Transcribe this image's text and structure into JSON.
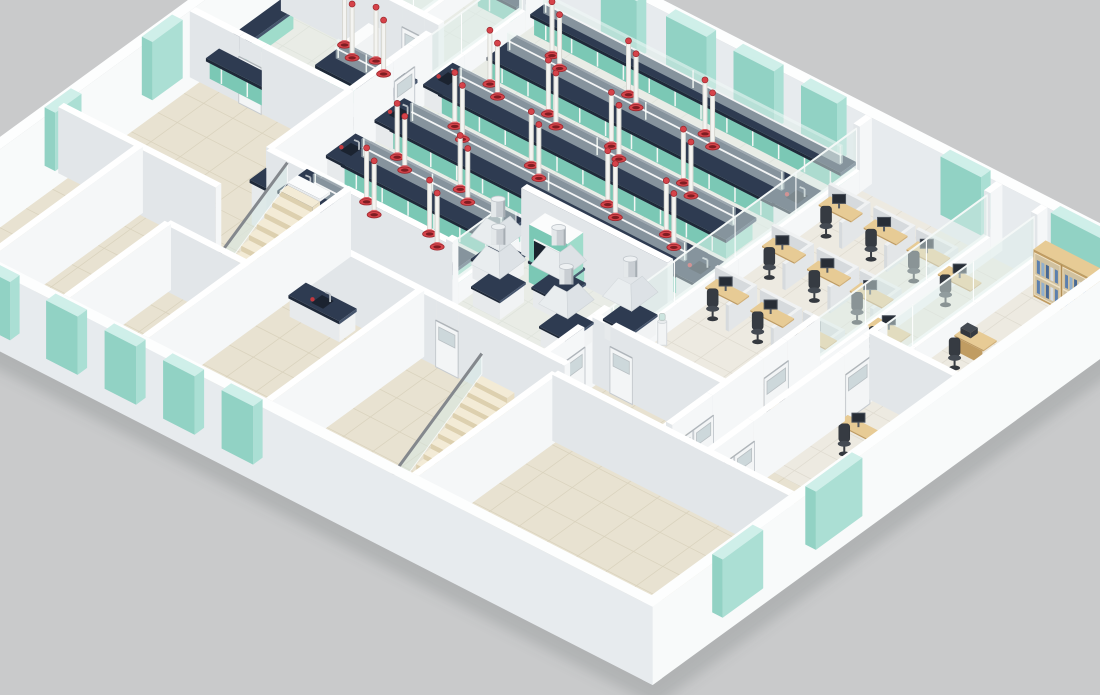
{
  "palette": {
    "background": "#c9cacb",
    "shadow": "rgba(95,98,100,0.22)",
    "wall_top": "#ffffff",
    "wall_se": "#f5f7f8",
    "wall_sw": "#e2e6e9",
    "ext_top": "#fdfefe",
    "ext_se": "#f8fafa",
    "ext_sw": "#e7ebee",
    "floor_lab": "#e9ece6",
    "floor_lab_line": "#dee3db",
    "floor_beige": "#e8e2d1",
    "floor_beige_line": "#d9d2bd",
    "floor_office": "#edeae1",
    "floor_office_line": "#dfdbd0",
    "counter_navy_top": "#2e3b51",
    "counter_navy_se": "#46556d",
    "counter_navy_sw": "#1f2939",
    "cabinet_teal_top": "#c9eee4",
    "cabinet_teal_se": "#9fdccb",
    "cabinet_teal_sw": "#7bc8b5",
    "window_teal_top": "#cdeee8",
    "window_teal_se": "#a8ded2",
    "window_teal_sw": "#8ed0c2",
    "glass_clear": "rgba(222,238,234,0.5)",
    "glass_edge": "rgba(255,255,255,0.85)",
    "wood_top": "#e7cb95",
    "wood_se": "#d2b077",
    "wood_sw": "#c09c62",
    "partition_top": "#f0f2f3",
    "partition_se": "#e3e6e8",
    "partition_sw": "#d6dadd",
    "stair_top": "#f3ebd6",
    "stair_se": "#eadfc4",
    "stair_sw": "#ddd0af",
    "white_top": "#fbfcfc",
    "white_se": "#f1f3f4",
    "white_sw": "#e7eaec",
    "extractor_red": "#d6434a",
    "extractor_red_deep": "#7e1d22",
    "extractor_red_edge": "#9c272d",
    "extractor_cone": "#e06066",
    "extractor_pole": "#f4f4f1",
    "extractor_pole_edge": "#d8d8d2",
    "chair_seat": "#444a52",
    "chair_back": "#363b42",
    "chair_base": "#34383e",
    "monitor": "#272d36",
    "monitor_edge": "#49505a",
    "chrome": "#c9ced3",
    "chrome_light": "#e4e8ea",
    "chrome_dark": "#a6adb3",
    "chrome_cap": "#eef1f3",
    "rail": "#84888d",
    "faucet": "#b9bfc5",
    "sink": "#1b2330",
    "bottle_red": "#c2383e",
    "door_leaf": "#f3f5f6",
    "door_edge": "#c6cbd0",
    "door_lite": "rgba(198,210,214,0.85)",
    "book_colors": [
      "#5b7fae",
      "#90b0cf",
      "#476894",
      "#d7dfe8"
    ]
  },
  "scene": {
    "floors": [
      {
        "n": "room-a-floor",
        "f": "lab",
        "r": [
          0,
          0,
          4.5,
          5
        ]
      },
      {
        "n": "room-b-floor",
        "f": "lab",
        "r": [
          4.5,
          0,
          7,
          5
        ]
      },
      {
        "n": "room-c-floor",
        "f": "lab",
        "r": [
          0,
          5,
          7,
          9.5
        ]
      },
      {
        "n": "mid-left-room-floor",
        "f": "beige",
        "r": [
          0,
          9.5,
          7,
          16
        ]
      },
      {
        "n": "main-lab-floor",
        "f": "lab",
        "r": [
          7,
          0,
          21.5,
          13.5
        ]
      },
      {
        "n": "corridor-floor",
        "f": "beige",
        "r": [
          10.5,
          13.5,
          16,
          16
        ]
      },
      {
        "n": "upper-stairwell-floor",
        "f": "beige",
        "r": [
          7,
          13.5,
          10.5,
          18.5
        ]
      },
      {
        "n": "office-floor",
        "f": "office",
        "r": [
          21.5,
          0,
          33,
          13.5
        ]
      },
      {
        "n": "south-corridor-floor",
        "f": "beige",
        "r": [
          21.5,
          13.5,
          33,
          16.6
        ]
      },
      {
        "n": "bottom-left-room-1-floor",
        "f": "beige",
        "r": [
          0,
          16,
          3.5,
          23.5
        ]
      },
      {
        "n": "bottom-left-room-2-floor",
        "f": "beige",
        "r": [
          3.5,
          16,
          7,
          23.5
        ]
      },
      {
        "n": "bottom-left-room-3-floor",
        "f": "beige",
        "r": [
          7,
          18.5,
          10.5,
          23.5
        ]
      },
      {
        "n": "bottom-mid-room-floor",
        "f": "beige",
        "r": [
          10.5,
          16,
          16,
          23.5
        ]
      },
      {
        "n": "lower-stairwell-floor",
        "f": "beige",
        "r": [
          16,
          16,
          22.5,
          23.5
        ]
      },
      {
        "n": "bottom-right-floor",
        "f": "beige",
        "r": [
          22.5,
          16.6,
          33,
          23.5
        ]
      }
    ],
    "ext_walls": [
      {
        "n": "exterior-wall-northwest",
        "axis": "a",
        "c": -0.225,
        "s": [
          -0.45,
          23.5
        ],
        "far": true,
        "win": [
          [
            2.5,
            4.5
          ],
          [
            10,
            11.5
          ],
          [
            15,
            16.3
          ],
          [
            19.5,
            21.2
          ]
        ]
      },
      {
        "n": "exterior-wall-northeast",
        "axis": "b",
        "c": -0.225,
        "s": [
          -0.45,
          33.45
        ],
        "far": true,
        "win": [
          [
            9.6,
            11.2
          ],
          [
            12.5,
            14.3
          ],
          [
            15.5,
            17.3
          ],
          [
            18.5,
            20.1
          ],
          [
            24.7,
            26.5
          ],
          [
            29.6,
            32.8
          ]
        ]
      },
      {
        "n": "exterior-wall-southwest",
        "axis": "b",
        "c": 23.725,
        "s": [
          -0.45,
          33.45
        ],
        "far": false,
        "win": [
          [
            0.9,
            2.3
          ],
          [
            3.5,
            4.9
          ],
          [
            6.5,
            7.9
          ],
          [
            9.1,
            10.5
          ],
          [
            11.7,
            13.1
          ],
          [
            14.3,
            15.7
          ]
        ]
      },
      {
        "n": "exterior-wall-southeast",
        "axis": "a",
        "c": 33.225,
        "s": [
          -0.45,
          23.95
        ],
        "far": false,
        "win": [
          [
            13.6,
            15.9
          ],
          [
            18.5,
            20.5
          ]
        ]
      }
    ],
    "walls": [
      {
        "n": "lab-suite-divider",
        "axis": "a",
        "c": 7,
        "s": [
          0,
          9.5
        ],
        "glass": [
          [
            1.0,
            5.6,
            0.95,
            2.8
          ]
        ],
        "doors": [
          [
            6.5,
            7.5,
            "single"
          ]
        ]
      },
      {
        "n": "room-ab-divider",
        "axis": "a",
        "c": 4.5,
        "s": [
          0,
          5
        ],
        "glass": [
          [
            0.6,
            4.4,
            0.95,
            2.8
          ]
        ]
      },
      {
        "n": "room-a-south-wall",
        "axis": "b",
        "c": 5,
        "s": [
          0,
          7
        ],
        "doors": [
          [
            5.4,
            6.4,
            "single"
          ]
        ]
      },
      {
        "n": "suite-south-wall",
        "axis": "b",
        "c": 9.5,
        "s": [
          0,
          7
        ],
        "doors": [
          [
            2.2,
            3.2,
            "single"
          ]
        ]
      },
      {
        "n": "mid-left-divider",
        "axis": "a",
        "c": 7,
        "s": [
          9.5,
          13.5
        ]
      },
      {
        "n": "lab-south-wall",
        "axis": "b",
        "c": 13.5,
        "s": [
          7,
          15
        ],
        "doors": [
          [
            9.4,
            10.4,
            "glass"
          ]
        ]
      },
      {
        "n": "stairwell-east-wall",
        "axis": "a",
        "c": 10.5,
        "s": [
          13.5,
          23.5
        ]
      },
      {
        "n": "upper-stairwell-south-wall",
        "axis": "b",
        "c": 18.5,
        "s": [
          7,
          10.5
        ]
      },
      {
        "n": "mid-left-south-wall",
        "axis": "b",
        "c": 16,
        "s": [
          0,
          7
        ]
      },
      {
        "n": "bottom-left-divider-1",
        "axis": "a",
        "c": 3.5,
        "s": [
          16,
          23.5
        ]
      },
      {
        "n": "bottom-left-divider-2",
        "axis": "a",
        "c": 7,
        "s": [
          18.5,
          23.5
        ]
      },
      {
        "n": "south-rooms-north-wall",
        "axis": "b",
        "c": 16,
        "s": [
          10.5,
          22.5
        ],
        "doors": [
          [
            16.8,
            17.8,
            "single"
          ]
        ]
      },
      {
        "n": "bottom-mid-divider",
        "axis": "a",
        "c": 16,
        "s": [
          16,
          23.5
        ]
      },
      {
        "n": "lower-stairwell-east-wall",
        "axis": "a",
        "c": 22.5,
        "s": [
          16.6,
          23.5
        ]
      },
      {
        "n": "wash-room-north-wall",
        "axis": "b",
        "c": 9.8,
        "s": [
          15,
          21.5
        ]
      },
      {
        "n": "wash-room-west-wall",
        "axis": "a",
        "c": 15,
        "s": [
          9.8,
          13.5
        ],
        "glass": [
          [
            10.2,
            13.2,
            0.95,
            2.8
          ]
        ]
      },
      {
        "n": "lab-office-glass-divider",
        "axis": "a",
        "c": 21.5,
        "s": [
          0,
          13.5
        ],
        "glass": [
          [
            0.6,
            12.9,
            1.0,
            2.85
          ]
        ]
      },
      {
        "n": "corridor-door-wall",
        "axis": "a",
        "c": 21.5,
        "s": [
          13.5,
          16.6
        ],
        "doors": [
          [
            14.2,
            16.2,
            "double"
          ]
        ]
      },
      {
        "n": "office-room-divider-1",
        "axis": "a",
        "c": 27.3,
        "s": [
          0,
          16.5
        ],
        "glass": [
          [
            0.6,
            9.0,
            1.0,
            2.85
          ]
        ],
        "doors": [
          [
            10.6,
            11.8,
            "single"
          ],
          [
            14.3,
            16.3,
            "double"
          ]
        ]
      },
      {
        "n": "office-room-divider-2",
        "axis": "a",
        "c": 29.3,
        "s": [
          0,
          16.6
        ],
        "glass": [
          [
            0.5,
            7.9,
            1.0,
            2.85
          ]
        ],
        "doors": [
          [
            8.8,
            10.0,
            "single"
          ],
          [
            14.5,
            16.5,
            "double"
          ]
        ]
      },
      {
        "n": "private-office-south-wall",
        "axis": "b",
        "c": 8.5,
        "s": [
          29.3,
          33
        ]
      },
      {
        "n": "office-south-wall",
        "axis": "b",
        "c": 13.5,
        "s": [
          21.5,
          27.3
        ],
        "doors": [
          [
            22.3,
            23.3,
            "single"
          ]
        ]
      },
      {
        "n": "southeast-corridor-wall",
        "axis": "b",
        "c": 16.6,
        "s": [
          22.5,
          33
        ]
      }
    ],
    "wall_benches": [
      {
        "n": "room-a-wall-bench",
        "r": [
          0.4,
          0.35,
          4.2,
          1.05
        ]
      },
      {
        "n": "room-a-side-bench",
        "r": [
          0.35,
          0.5,
          1.05,
          4.3
        ]
      },
      {
        "n": "room-b-wall-bench",
        "r": [
          4.9,
          0.35,
          6.8,
          1.05
        ]
      },
      {
        "n": "room-c-side-bench",
        "r": [
          0.35,
          5.5,
          1.05,
          9.2
        ]
      },
      {
        "n": "suite-south-counter",
        "r": [
          0.5,
          8.75,
          6.8,
          9.4
        ]
      },
      {
        "n": "lab-wall-bench",
        "r": [
          7.4,
          0.3,
          21.2,
          1.05
        ],
        "riser": true
      }
    ],
    "island_benches": [
      {
        "n": "lab-island-bench-1",
        "a0": 7.8,
        "a1": 20.6,
        "b": 2.9
      },
      {
        "n": "lab-island-bench-2",
        "a0": 7.8,
        "a1": 20.6,
        "b": 5.3
      },
      {
        "n": "lab-island-bench-3",
        "a0": 7.8,
        "a1": 20.6,
        "b": 7.7
      },
      {
        "n": "lab-island-bench-4",
        "a0": 7.8,
        "a1": 14.6,
        "b": 10.1
      },
      {
        "n": "lab-island-bench-5",
        "a0": 7.8,
        "a1": 14.6,
        "b": 12.5
      },
      {
        "n": "room-c-island-bench",
        "a0": 3.6,
        "a1": 6.8,
        "b": 6.7
      }
    ],
    "extractor_stations": [
      [
        10.2,
        2.9
      ],
      [
        13.6,
        2.9
      ],
      [
        17.0,
        2.9
      ],
      [
        9.6,
        5.3
      ],
      [
        12.2,
        5.3
      ],
      [
        15.0,
        5.3
      ],
      [
        18.2,
        5.3
      ],
      [
        10.2,
        7.7
      ],
      [
        13.6,
        7.7
      ],
      [
        17.0,
        7.7
      ],
      [
        19.6,
        7.7
      ],
      [
        9.8,
        10.1
      ],
      [
        12.6,
        10.1
      ],
      [
        10.6,
        12.5
      ],
      [
        13.4,
        12.5
      ],
      [
        4.4,
        6.7
      ],
      [
        5.8,
        6.7
      ]
    ],
    "sinks": [
      {
        "n": "bench-end-sink-1",
        "r": [
          7.15,
          4.6,
          8.05,
          6.0
        ],
        "kb": 2.5
      },
      {
        "n": "bench-end-sink-2",
        "r": [
          7.15,
          7.0,
          8.05,
          8.4
        ],
        "kb": 2.5
      },
      {
        "n": "bench-end-sink-3",
        "r": [
          7.15,
          9.4,
          8.05,
          10.8
        ],
        "kb": 2.5
      },
      {
        "n": "bench-end-sink-4",
        "r": [
          7.15,
          11.8,
          8.05,
          13.2
        ],
        "kb": 2.5
      },
      {
        "n": "bench-end-sink-5",
        "r": [
          20.5,
          2.2,
          21.35,
          3.6
        ],
        "kb": 0
      },
      {
        "n": "bench-end-sink-6",
        "r": [
          20.5,
          7.0,
          21.35,
          8.4
        ],
        "kb": 0
      },
      {
        "n": "washroom-vanity",
        "r": [
          11.2,
          16.35,
          13.4,
          17.15
        ],
        "kb": 5
      }
    ],
    "fume_hood": {
      "n": "fume-hood",
      "r": [
        16.2,
        10.05,
        17.9,
        10.9
      ]
    },
    "canopy_hoods": [
      [
        15.2,
        11.3
      ],
      [
        16.2,
        12.4
      ],
      [
        17.8,
        11.2
      ],
      [
        19.4,
        12.6
      ],
      [
        20.8,
        11.0
      ]
    ],
    "white_table": {
      "n": "corridor-table",
      "r": [
        19.6,
        13.7,
        21.3,
        14.35
      ]
    },
    "stair_counter": {
      "n": "stair-landing-counter",
      "r": [
        6.9,
        13.55,
        8.35,
        14.25
      ]
    },
    "wall_cabinet": {
      "n": "teal-wall-cabinet",
      "r": [
        0.5,
        0.12,
        2.3,
        0.72
      ],
      "h": [
        1.45,
        2.2
      ]
    },
    "drawer_unit": {
      "n": "white-drawer-unit",
      "r": [
        3.95,
        5.2,
        4.45,
        6.9
      ],
      "h": [
        0,
        1.55
      ]
    },
    "cubicles": [
      [
        22.3,
        2.6
      ],
      [
        24.3,
        2.6
      ],
      [
        26.2,
        2.6
      ],
      [
        22.3,
        5.4
      ],
      [
        24.3,
        5.4
      ],
      [
        26.2,
        5.4
      ],
      [
        22.3,
        8.2
      ],
      [
        24.3,
        8.2
      ],
      [
        26.2,
        8.2
      ]
    ],
    "side_desks": [
      [
        27.9,
        2.9
      ],
      [
        27.9,
        6.4
      ],
      [
        28.2,
        11.8
      ],
      [
        30.6,
        10.9
      ]
    ],
    "private_office": {
      "bookcase": {
        "n": "wood-bookcase",
        "r": [
          29.9,
          0.6,
          32.4,
          1.2
        ],
        "h": 2.15
      },
      "desk": {
        "n": "private-desk",
        "r": [
          29.8,
          4.35,
          31.1,
          5.0
        ]
      },
      "chair": [
        30.4,
        5.65
      ],
      "printer": {
        "n": "desk-printer",
        "r": [
          29.9,
          4.45,
          30.35,
          4.8
        ]
      }
    },
    "water_cooler": [
      21.95,
      10.7
    ],
    "stairs": [
      {
        "n": "upper-staircase",
        "x0": 8.35,
        "x1": 9.8,
        "b": 17.9,
        "steps": 10,
        "tread": 0.38,
        "rise": 0.245,
        "landing": true,
        "winder": false
      },
      {
        "n": "lower-staircase",
        "x0": 20.7,
        "x1": 22.15,
        "b": 22.9,
        "steps": 13,
        "tread": 0.36,
        "rise": 0.23,
        "landing": false,
        "winder": true
      }
    ]
  }
}
